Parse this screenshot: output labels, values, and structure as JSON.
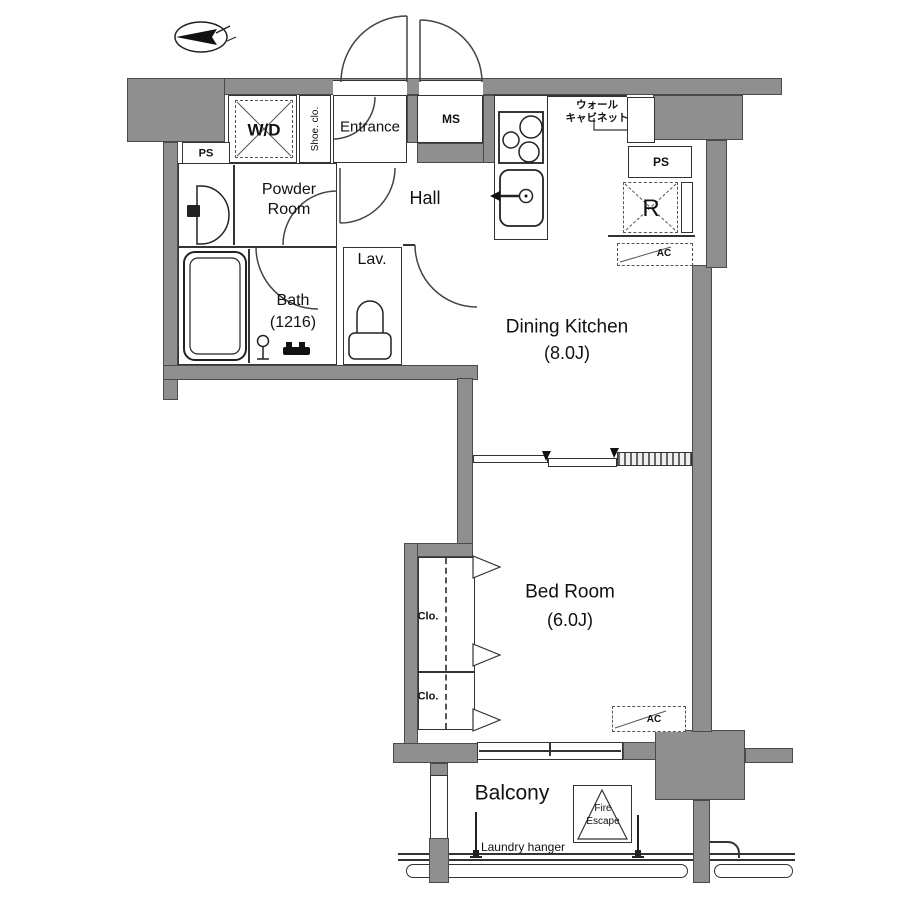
{
  "labels": {
    "ps_left": "PS",
    "washer_dryer": "W/D",
    "shoe_closet": "Shoe. clo.",
    "entrance": "Entrance",
    "ms": "MS",
    "wall_cabinet_line1": "ウォール",
    "wall_cabinet_line2": "キャビネット",
    "ps_right": "PS",
    "refrigerator": "R",
    "ac": "AC",
    "powder_line1": "Powder",
    "powder_line2": "Room",
    "hall": "Hall",
    "lavatory": "Lav.",
    "bath_line1": "Bath",
    "bath_line2": "(1216)",
    "dining_line1": "Dining Kitchen",
    "dining_line2": "(8.0J)",
    "bed_line1": "Bed Room",
    "bed_line2": "(6.0J)",
    "closet": "Clo.",
    "balcony": "Balcony",
    "fire_line1": "Fire",
    "fire_line2": "Escape",
    "laundry": "Laundry hanger"
  },
  "icons": {
    "compass": "north-arrow",
    "kitchen": [
      "stove-burners",
      "kitchen-sink"
    ],
    "bathroom": [
      "bathtub",
      "shower-head",
      "bath-faucet",
      "washbasin",
      "toilet"
    ],
    "symbols": [
      "door-swing-arc",
      "sliding-door",
      "folding-closet-door",
      "fire-escape-hatch",
      "laundry-pole",
      "balcony-railing"
    ]
  },
  "colors": {
    "wall": "#8f8f8f",
    "line": "#333333",
    "text": "#111111",
    "background": "#ffffff"
  }
}
